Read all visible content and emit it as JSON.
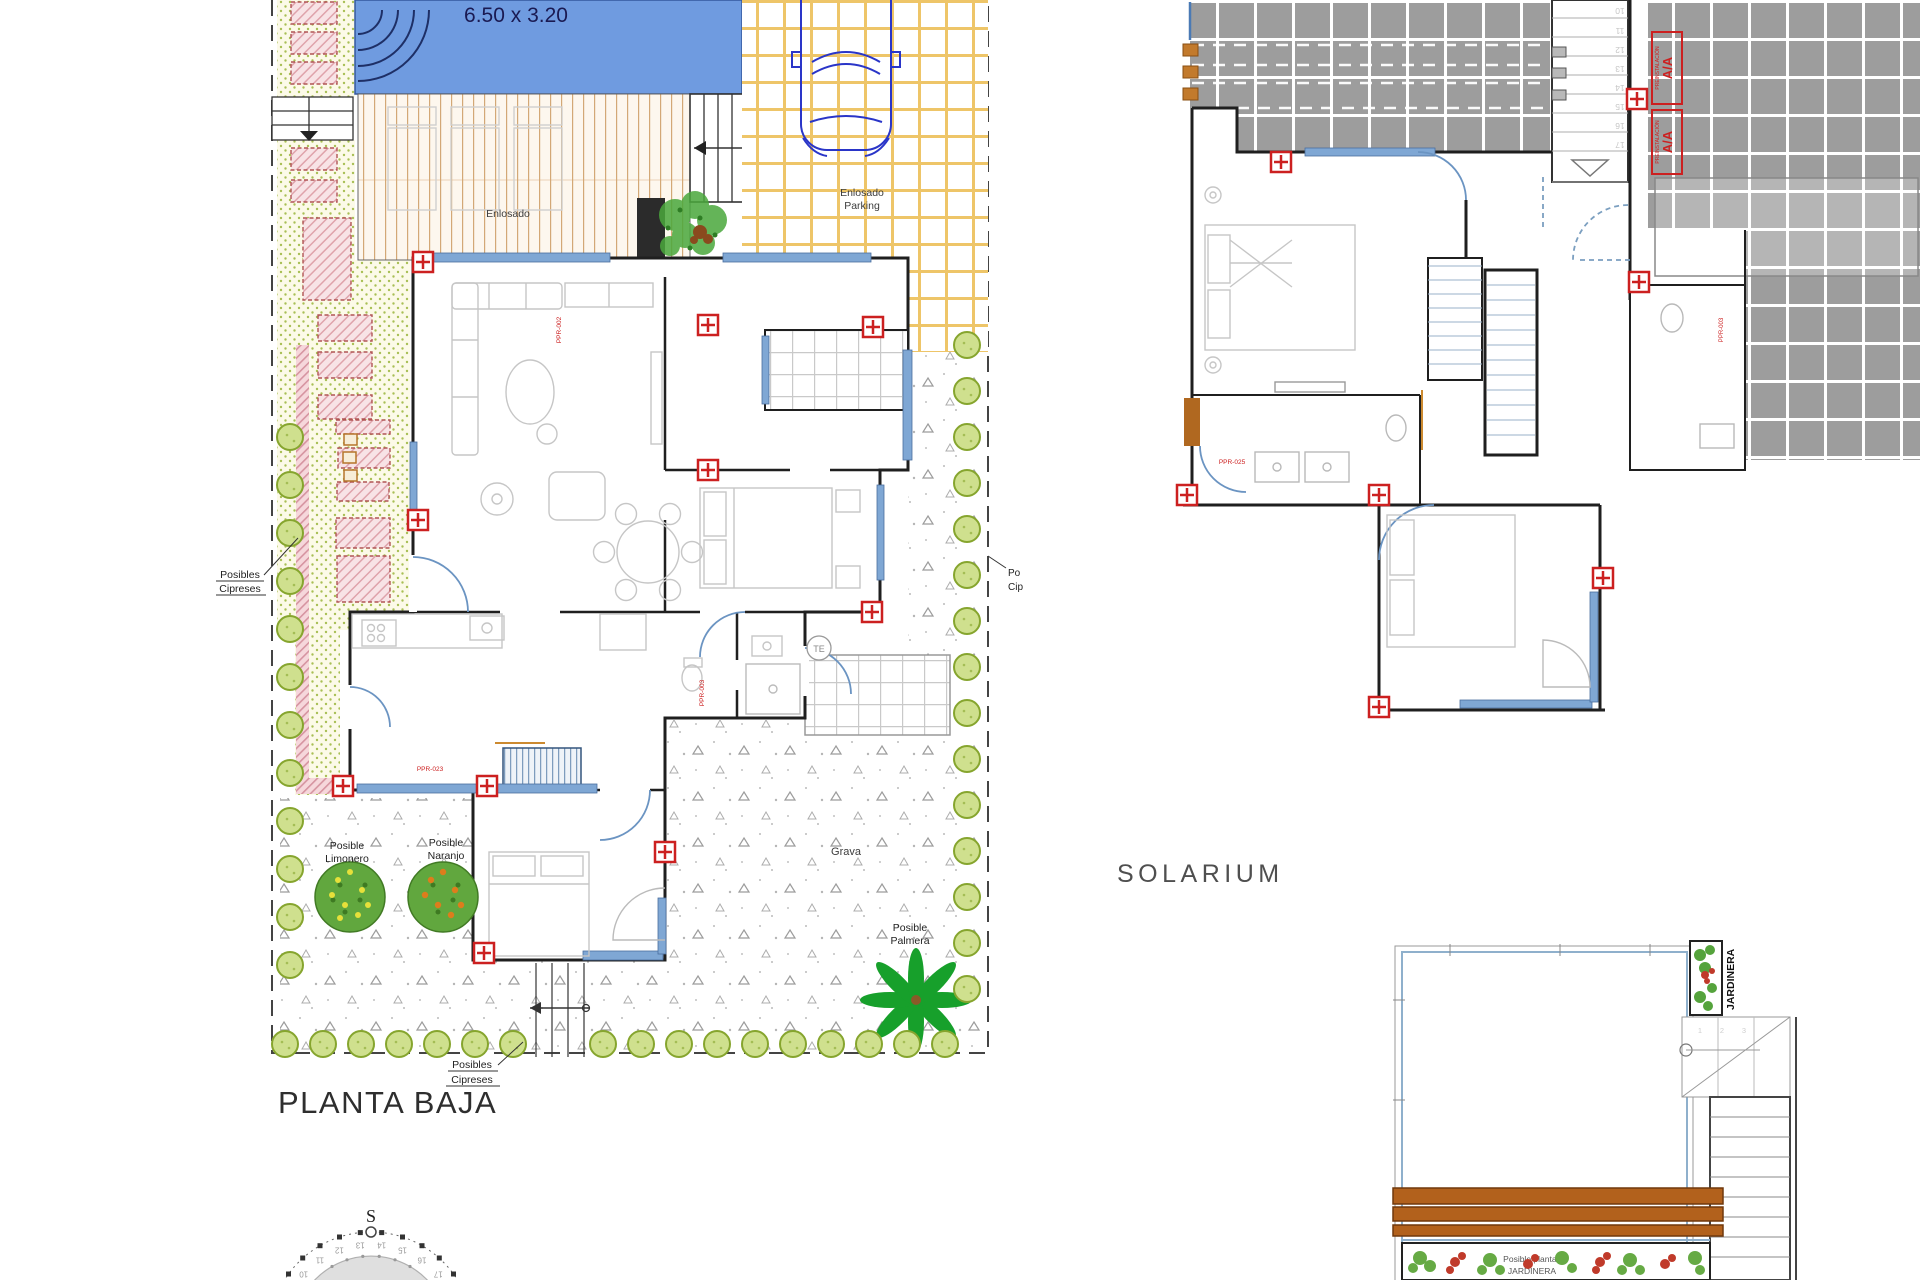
{
  "colors": {
    "pool_blue": "#6f9be0",
    "marker_red": "#cc2020",
    "pergola_brown": "#b2611c",
    "roof_tile_gray": "#9d9d9d",
    "cypress_green": "#cfe08e",
    "parking_grid_yellow": "#eec568"
  },
  "plans": {
    "ground": {
      "title": "PLANTA BAJA",
      "pool_dim": "6.50 x 3.20",
      "deck_label": "Enlosado",
      "parking_line1": "Enlosado",
      "parking_line2": "Parking",
      "cip1": "Posibles",
      "cip2": "Cipreses",
      "po_short": "Po",
      "cip_short": "Cip",
      "lim1": "Posible",
      "lim2": "Limonero",
      "nar1": "Posible",
      "nar2": "Naranjo",
      "palm1": "Posible",
      "palm2": "Palmera",
      "grava": "Grava",
      "te": "TE",
      "code_a": "PPR-002",
      "code_b": "PPR-023",
      "code_c": "PPR-003",
      "compass_s": "S",
      "compass_hours": [
        "10",
        "11",
        "12",
        "13",
        "14",
        "15",
        "16",
        "17"
      ]
    },
    "upper": {
      "solarium_title": "SOLARIUM",
      "ac_big": "A/A",
      "ac_small": "PREINSTALACIÓN",
      "stair_numbers": [
        "10",
        "11",
        "12",
        "13",
        "14",
        "15",
        "16",
        "17"
      ],
      "code_d": "PPR-025",
      "code_e": "PPR-003"
    },
    "solarium_terrace": {
      "jardinera": "JARDINERA",
      "planter_line1": "Posible plantas",
      "planter_line2": "JARDINERA",
      "steps": [
        "1",
        "2",
        "3"
      ]
    }
  }
}
